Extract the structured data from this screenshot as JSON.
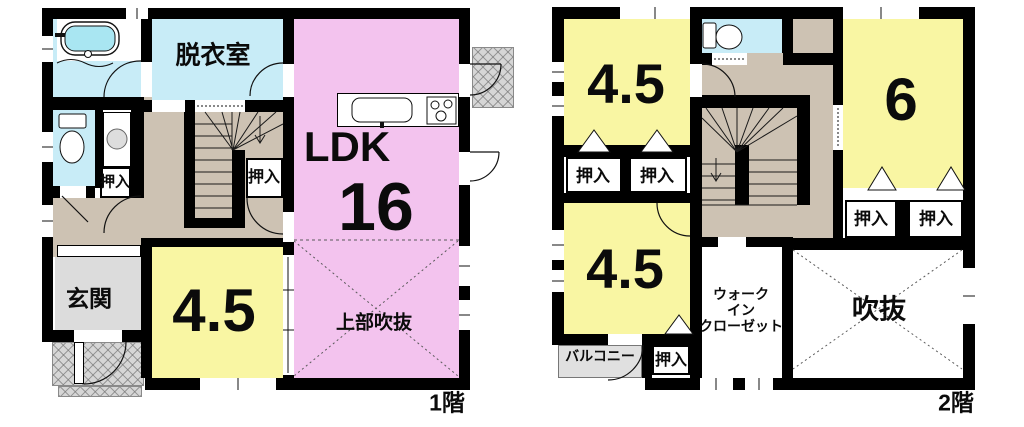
{
  "colors": {
    "wall": "#000000",
    "ldk_pink": "#f3c3ee",
    "room_yellow": "#f9f6a3",
    "wet_cyan": "#c8ecf7",
    "tub_water": "#a9e6f2",
    "hall_tan": "#cdc2b3",
    "genkan_gray": "#dcdcdc",
    "balcony_gray": "#e0e0e0",
    "porch_gray": "#d6d6d6"
  },
  "floor1": {
    "label": "1階",
    "dressing_room": "脱衣室",
    "ldk_name": "LDK",
    "ldk_size": "16",
    "upper_void": "上部吹抜",
    "entrance": "玄関",
    "tatami_room_size": "4.5",
    "closet": "押入"
  },
  "floor2": {
    "label": "2階",
    "room_nw_size": "4.5",
    "room_ne_size": "6",
    "room_sw_size": "4.5",
    "closet": "押入",
    "walk_in_closet_line1": "ウォーク",
    "walk_in_closet_line2": "イン",
    "walk_in_closet_line3": "クローゼット",
    "void": "吹抜",
    "balcony": "バルコニー"
  }
}
